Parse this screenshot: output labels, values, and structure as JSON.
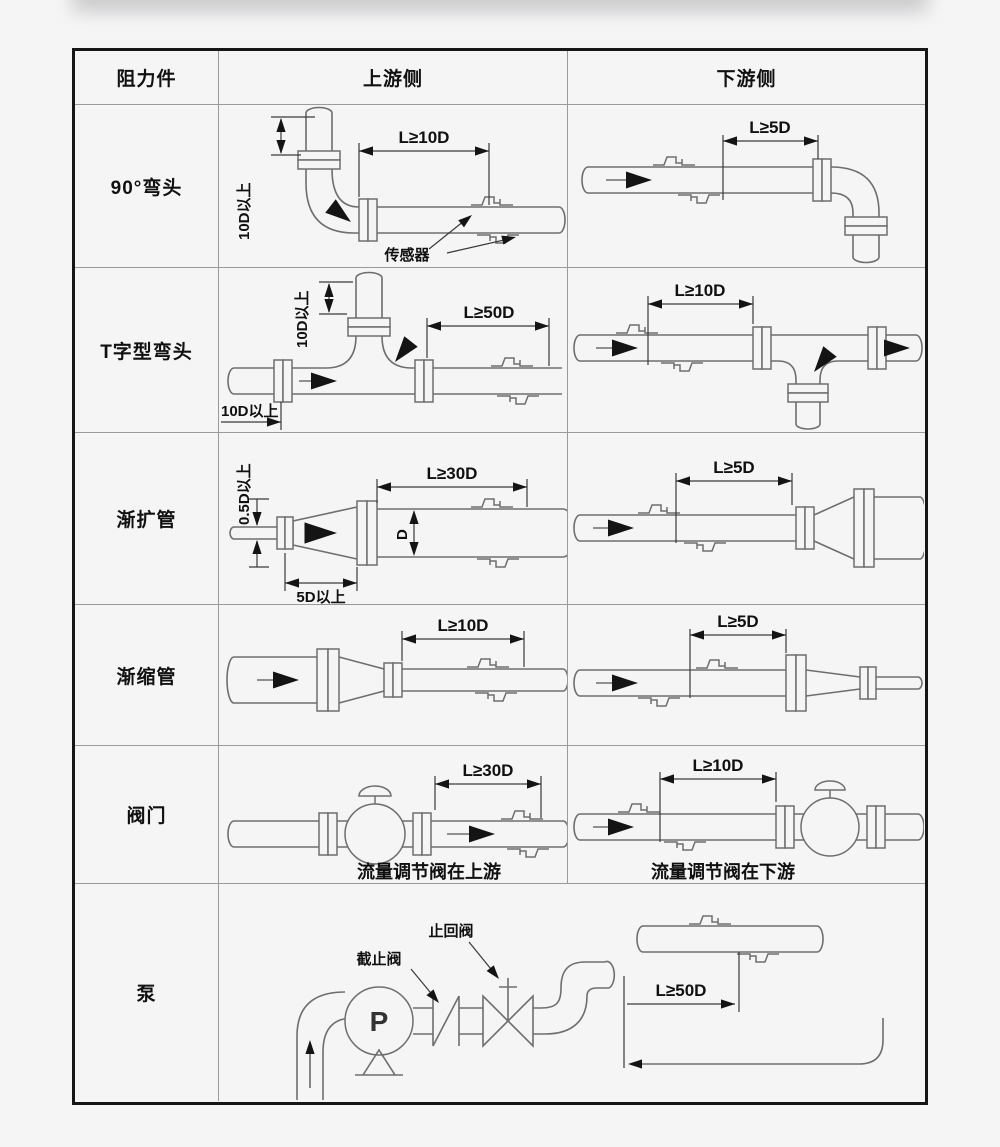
{
  "style": {
    "page_bg": "#f5f5f6",
    "line_color": "#6e6e6e",
    "border_color": "#161616"
  },
  "table": {
    "header": {
      "col1": "阻力件",
      "col2": "上游侧",
      "col3": "下游侧"
    },
    "rows": [
      {
        "label": "90°弯头",
        "up": {
          "dim_main": "L≥10D",
          "dim_side": "10D以上",
          "sensor_label": "传感器"
        },
        "down": {
          "dim_main": "L≥5D"
        }
      },
      {
        "label": "T字型弯头",
        "up": {
          "dim_main": "L≥50D",
          "dim_top": "10D以上",
          "dim_left": "10D以上"
        },
        "down": {
          "dim_main": "L≥10D"
        }
      },
      {
        "label": "渐扩管",
        "up": {
          "dim_main": "L≥30D",
          "dim_side": "0.5D以上",
          "dim_bottom": "5D以上",
          "dim_d": "D"
        },
        "down": {
          "dim_main": "L≥5D"
        }
      },
      {
        "label": "渐缩管",
        "up": {
          "dim_main": "L≥10D"
        },
        "down": {
          "dim_main": "L≥5D"
        }
      },
      {
        "label": "阀门",
        "up": {
          "dim_main": "L≥30D",
          "caption": "流量调节阀在上游"
        },
        "down": {
          "dim_main": "L≥10D",
          "caption": "流量调节阀在下游"
        }
      },
      {
        "label": "泵",
        "pump_letter": "P",
        "stop_valve_label": "截止阀",
        "check_valve_label": "止回阀",
        "dim_main": "L≥50D"
      }
    ]
  }
}
